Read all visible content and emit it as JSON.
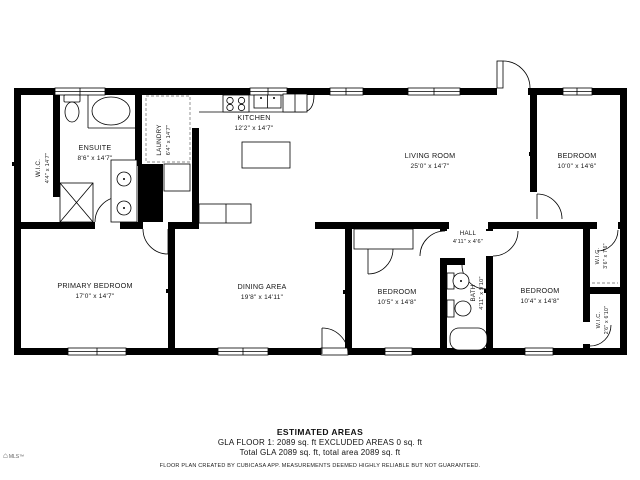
{
  "rooms": {
    "wic1": {
      "name": "W.I.C.",
      "dims": "4'4\" x 14'7\""
    },
    "ensuite": {
      "name": "ENSUITE",
      "dims": "8'6\" x 14'7\""
    },
    "laundry": {
      "name": "LAUNDRY",
      "dims": "6'4\" x 14'7\""
    },
    "kitchen": {
      "name": "KITCHEN",
      "dims": "12'2\" x 14'7\""
    },
    "living": {
      "name": "LIVING ROOM",
      "dims": "25'0\" x 14'7\""
    },
    "bedroom_top_right": {
      "name": "BEDROOM",
      "dims": "10'0\" x 14'6\""
    },
    "primary": {
      "name": "PRIMARY BEDROOM",
      "dims": "17'0\" x 14'7\""
    },
    "dining": {
      "name": "DINING AREA",
      "dims": "19'8\" x 14'11\""
    },
    "bedroom_bottom_left": {
      "name": "BEDROOM",
      "dims": "10'5\" x 14'8\""
    },
    "hall": {
      "name": "HALL",
      "dims": "4'11\" x 4'6\""
    },
    "bath": {
      "name": "BATH",
      "dims": "4'11\" x 9'10\""
    },
    "bedroom_bottom_right": {
      "name": "BEDROOM",
      "dims": "10'4\" x 14'8\""
    },
    "wic2": {
      "name": "W.I.C.",
      "dims": "3'6\" x 7'6\""
    },
    "wic3": {
      "name": "W.I.C.",
      "dims": "2'6\" x 6'10\""
    }
  },
  "footer": {
    "title": "ESTIMATED AREAS",
    "line1": "GLA FLOOR 1: 2089 sq. ft EXCLUDED AREAS 0 sq. ft",
    "line2": "Total GLA 2089 sq. ft, total area 2089 sq. ft",
    "disclaimer": "FLOOR PLAN CREATED BY CUBICASA APP. MEASUREMENTS DEEMED HIGHLY RELIABLE BUT NOT GUARANTEED.",
    "logo": "MLS™"
  }
}
